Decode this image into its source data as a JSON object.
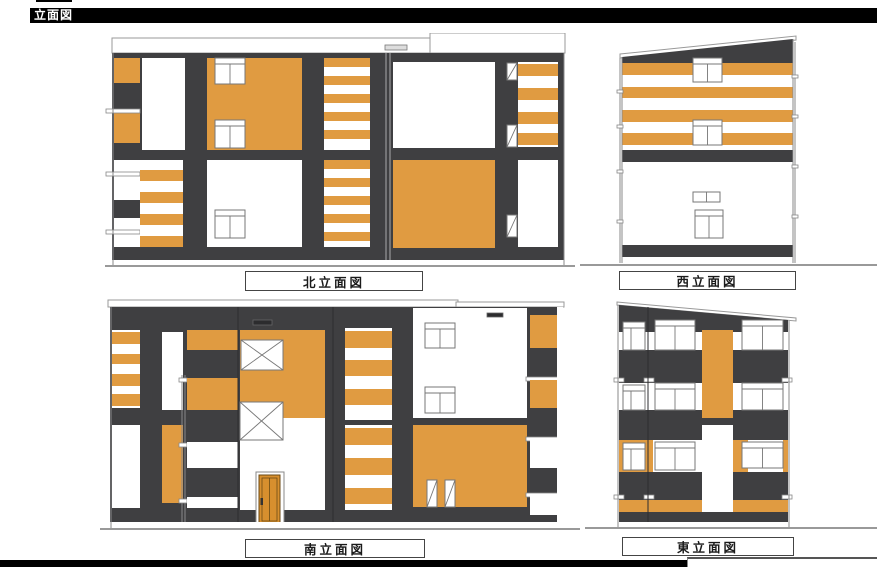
{
  "page": {
    "title": "立面図"
  },
  "elevations": {
    "north": {
      "label": "北立面図"
    },
    "west": {
      "label": "西立面図"
    },
    "south": {
      "label": "南立面図"
    },
    "east": {
      "label": "東立面図"
    }
  },
  "colors": {
    "header_bg": "#000000",
    "header_text": "#FFFFFF",
    "accent_orange": "#E09B41",
    "wall_dark": "#3F3F41",
    "door_orange": "#D78F2E",
    "line_gray": "#999999"
  }
}
